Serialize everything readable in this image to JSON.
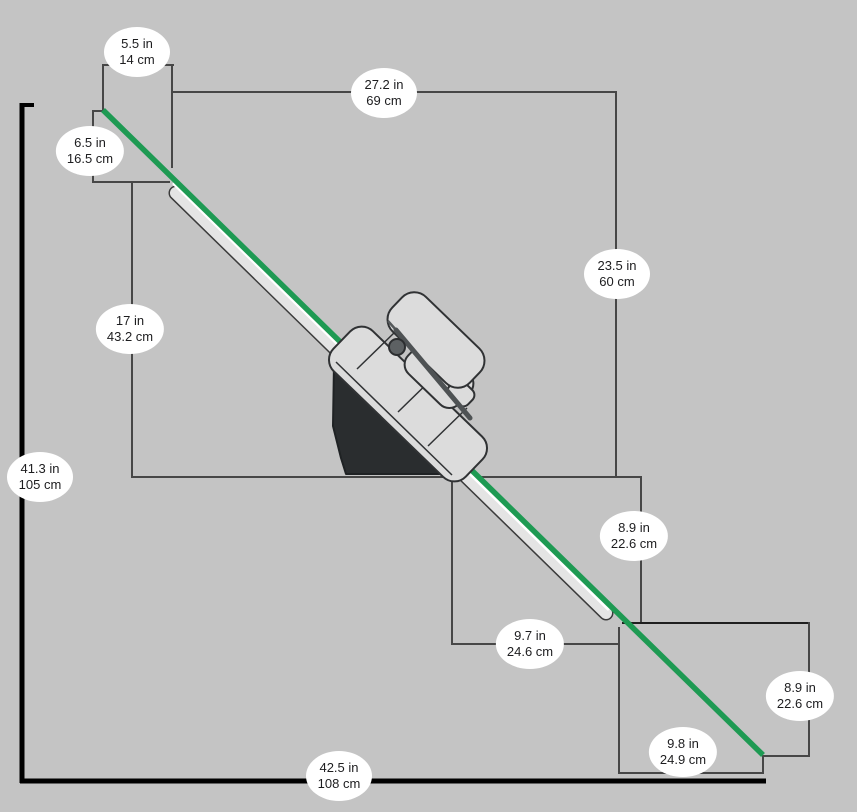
{
  "title": "Inclined rail machine dimension diagram",
  "colors": {
    "background": "#c4c4c4",
    "rail_green": "#1e9a53",
    "rail_tube_fill": "#e4e4e4",
    "machine_dark_body": "#2a2d2f",
    "machine_light_body": "#dcdcdc",
    "dimension_line": "#474747",
    "baseline": "#000000",
    "badge_background": "#ffffff",
    "badge_text": "#1d1d1f"
  },
  "dimensions": [
    {
      "id": "top-offset-width",
      "in_label": "5.5 in",
      "cm_label": "14 cm",
      "x": 137,
      "y": 52
    },
    {
      "id": "upper-run-width",
      "in_label": "27.2 in",
      "cm_label": "69 cm",
      "x": 384,
      "y": 93
    },
    {
      "id": "top-offset-height",
      "in_label": "6.5 in",
      "cm_label": "16.5 cm",
      "x": 90,
      "y": 151
    },
    {
      "id": "upper-drop-height",
      "in_label": "23.5 in",
      "cm_label": "60 cm",
      "x": 617,
      "y": 274
    },
    {
      "id": "mid-left-height",
      "in_label": "17 in",
      "cm_label": "43.2 cm",
      "x": 130,
      "y": 329
    },
    {
      "id": "overall-height",
      "in_label": "41.3 in",
      "cm_label": "105 cm",
      "x": 40,
      "y": 477
    },
    {
      "id": "mid-drop-height",
      "in_label": "8.9 in",
      "cm_label": "22.6 cm",
      "x": 634,
      "y": 536
    },
    {
      "id": "mid-run-width",
      "in_label": "9.7 in",
      "cm_label": "24.6 cm",
      "x": 530,
      "y": 644
    },
    {
      "id": "lower-drop-height",
      "in_label": "8.9 in",
      "cm_label": "22.6 cm",
      "x": 800,
      "y": 696
    },
    {
      "id": "lower-run-width",
      "in_label": "9.8 in",
      "cm_label": "24.9 cm",
      "x": 683,
      "y": 752
    },
    {
      "id": "overall-width",
      "in_label": "42.5 in",
      "cm_label": "108 cm",
      "x": 339,
      "y": 776
    }
  ]
}
